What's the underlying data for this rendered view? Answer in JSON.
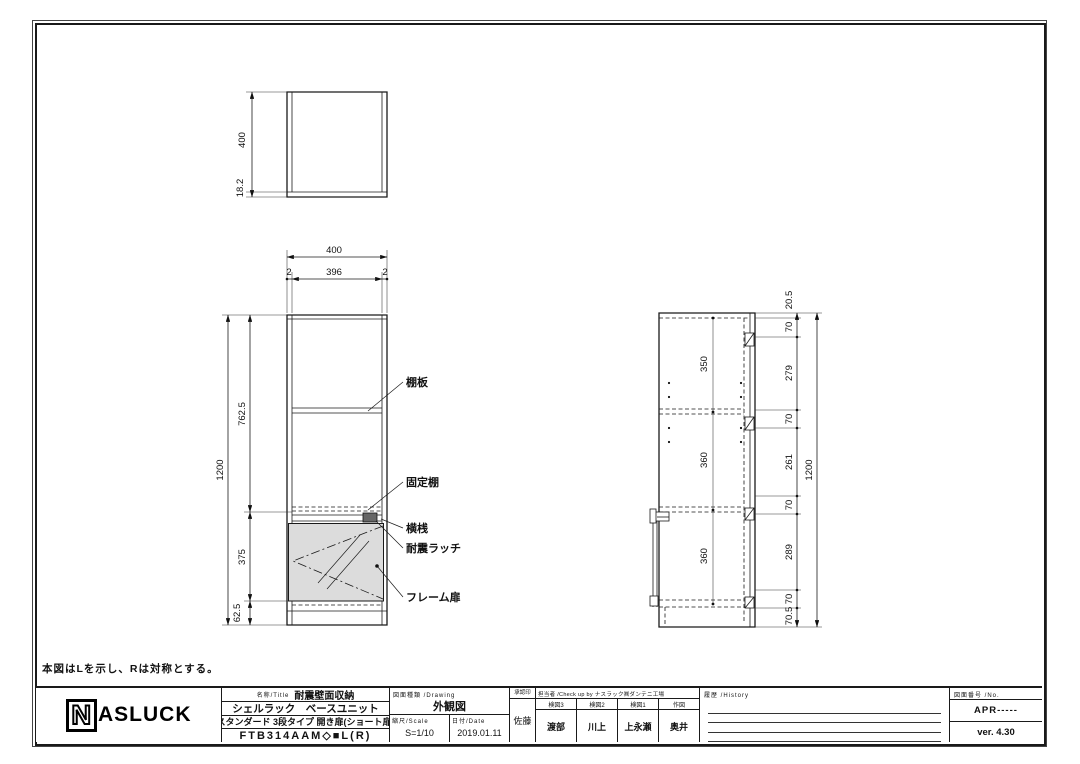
{
  "note_lr": "本図はLを示し、Rは対称とする。",
  "top_view": {
    "dim_depth": "400",
    "dim_back": "18.2"
  },
  "front_view": {
    "dim_width": "400",
    "dim_edge_left": "2",
    "dim_inner": "396",
    "dim_edge_right": "2",
    "dim_height": "1200",
    "dim_upper": "762.5",
    "dim_door": "375",
    "dim_base": "62.5",
    "labels": {
      "shelf": "棚板",
      "fixed_shelf": "固定棚",
      "rail": "横桟",
      "latch": "耐震ラッチ",
      "frame_door": "フレーム扉"
    }
  },
  "side_view": {
    "dim_top": "20.5",
    "dim_t1": "70",
    "dim_s1": "279",
    "dim_t2": "70",
    "dim_s2": "261",
    "dim_t3": "70",
    "dim_s3": "289",
    "dim_t4": "70",
    "dim_base": "70.5",
    "dim_height": "1200",
    "dim_i1": "350",
    "dim_i2": "360",
    "dim_i3": "360"
  },
  "title_block": {
    "logo_n": "N",
    "logo_rest": "ASLUCK",
    "title_label": "名称/Title",
    "title1": "耐震壁面収納",
    "title2": "シェルラック　ベースユニット",
    "title3": "スタンダード 3段タイプ 開き扉(ショート扉)",
    "title4": "FTB314AAM◇■L(R)",
    "drawing_label": "図面種類 /Drawing",
    "drawing_type": "外観図",
    "scale_label": "縮尺/Scale",
    "scale": "S=1/10",
    "date_label": "日付/Date",
    "date": "2019.01.11",
    "approval_label": "承認印",
    "approver": "佐藤",
    "check_label": "担当者 /Check up by ナスラック㈱ダンテニ工場",
    "check_cols": [
      {
        "role": "検図3",
        "name": "渡部"
      },
      {
        "role": "検図2",
        "name": "川上"
      },
      {
        "role": "検図1",
        "name": "上永瀬"
      },
      {
        "role": "作図",
        "name": "奥井"
      }
    ],
    "history_label": "履歴 /History",
    "no_label": "図面番号 /No.",
    "no_value": "APR-----",
    "version": "ver. 4.30"
  }
}
